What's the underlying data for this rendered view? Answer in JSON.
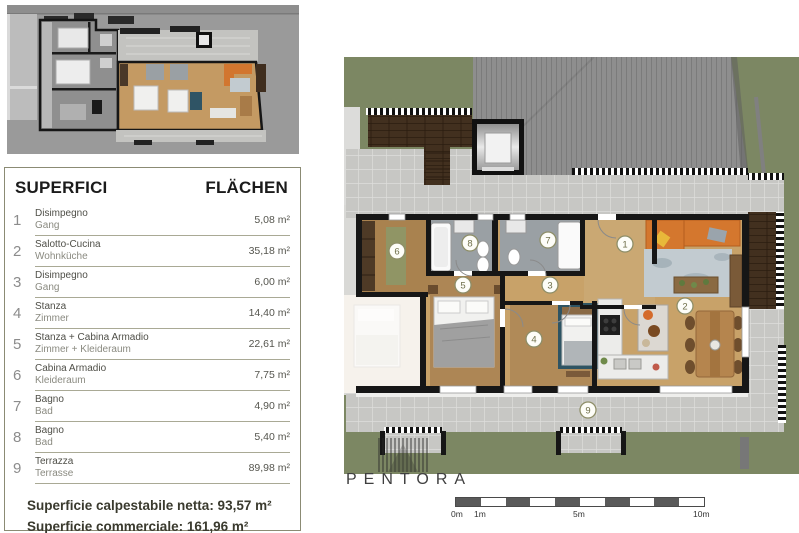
{
  "legend": {
    "title_left": "SUPERFICI",
    "title_right": "FLÄCHEN",
    "rows": [
      {
        "num": "1",
        "it": "Disimpegno",
        "de": "Gang",
        "area": "5,08 m²"
      },
      {
        "num": "2",
        "it": "Salotto-Cucina",
        "de": "Wohnküche",
        "area": "35,18 m²"
      },
      {
        "num": "3",
        "it": "Disimpegno",
        "de": "Gang",
        "area": "6,00 m²"
      },
      {
        "num": "4",
        "it": "Stanza",
        "de": "Zimmer",
        "area": "14,40 m²"
      },
      {
        "num": "5",
        "it": "Stanza + Cabina Armadio",
        "de": "Zimmer + Kleideraum",
        "area": "22,61 m²"
      },
      {
        "num": "6",
        "it": "Cabina Armadio",
        "de": "Kleideraum",
        "area": "7,75 m²"
      },
      {
        "num": "7",
        "it": "Bagno",
        "de": "Bad",
        "area": "4,90 m²"
      },
      {
        "num": "8",
        "it": "Bagno",
        "de": "Bad",
        "area": "5,40 m²"
      },
      {
        "num": "9",
        "it": "Terrazza",
        "de": "Terrasse",
        "area": "89,98 m²"
      }
    ],
    "totals": [
      "Superficie calpestabile netta: 93,57 m²",
      "Superficie commerciale: 161,96 m²"
    ]
  },
  "plan": {
    "markers": [
      "1",
      "2",
      "3",
      "4",
      "5",
      "6",
      "7",
      "8",
      "9"
    ],
    "brand": "PENTORA",
    "scale_labels": [
      "0m",
      "1m",
      "5m",
      "10m"
    ]
  },
  "colors": {
    "accent_olive": "#8b8b74",
    "grass": "#7c8763",
    "roof": "#8e8e8e",
    "tile": "#c6c6c3",
    "wood": "#c8a269",
    "sofa_orange": "#d4772e",
    "wall": "#161616"
  }
}
